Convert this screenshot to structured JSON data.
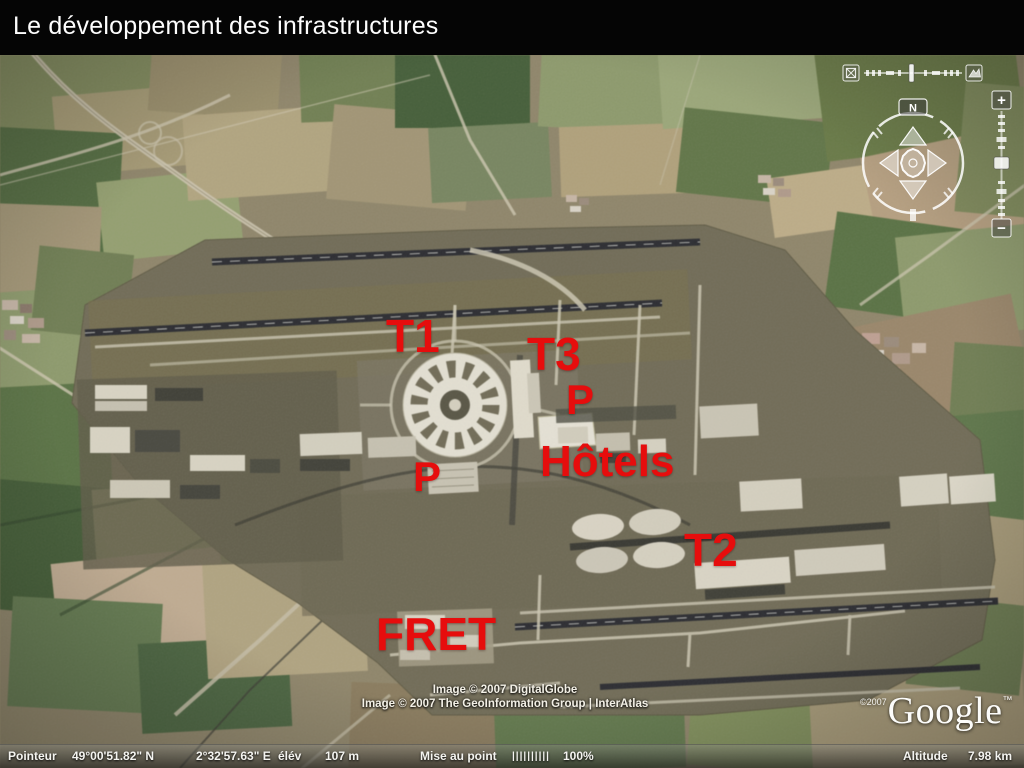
{
  "slide": {
    "title": "Le développement des infrastructures"
  },
  "map": {
    "annotation_color": "#e60d0d",
    "annotations": [
      {
        "id": "t1",
        "text": "T1",
        "x": 386,
        "y": 258,
        "size": 46
      },
      {
        "id": "t3",
        "text": "T3",
        "x": 527,
        "y": 276,
        "size": 46
      },
      {
        "id": "p-t3",
        "text": "P",
        "x": 566,
        "y": 324,
        "size": 42
      },
      {
        "id": "hotels",
        "text": "Hôtels",
        "x": 540,
        "y": 385,
        "size": 44
      },
      {
        "id": "p-t1",
        "text": "P",
        "x": 413,
        "y": 401,
        "size": 42
      },
      {
        "id": "t2",
        "text": "T2",
        "x": 684,
        "y": 472,
        "size": 46
      },
      {
        "id": "fret",
        "text": "FRET",
        "x": 376,
        "y": 556,
        "size": 46
      }
    ],
    "attribution_line1": "Image © 2007 DigitalGlobe",
    "attribution_line2": "Image © 2007 The GeoInformation Group | InterAtlas",
    "logo_copyright": "©2007",
    "logo_text": "Google",
    "logo_tm": "™"
  },
  "controls": {
    "compass_north_label": "N",
    "zoom_in_label": "+",
    "zoom_out_label": "−"
  },
  "statusbar": {
    "pointer_label": "Pointeur",
    "latitude": "49°00'51.82\" N",
    "longitude": "2°32'57.63\" E",
    "elevation_label": "élév",
    "elevation_value": "107 m",
    "focus_label": "Mise au point",
    "focus_ticks": "||||||||||",
    "focus_percent": "100%",
    "altitude_label": "Altitude",
    "altitude_value": "7.98 km"
  }
}
